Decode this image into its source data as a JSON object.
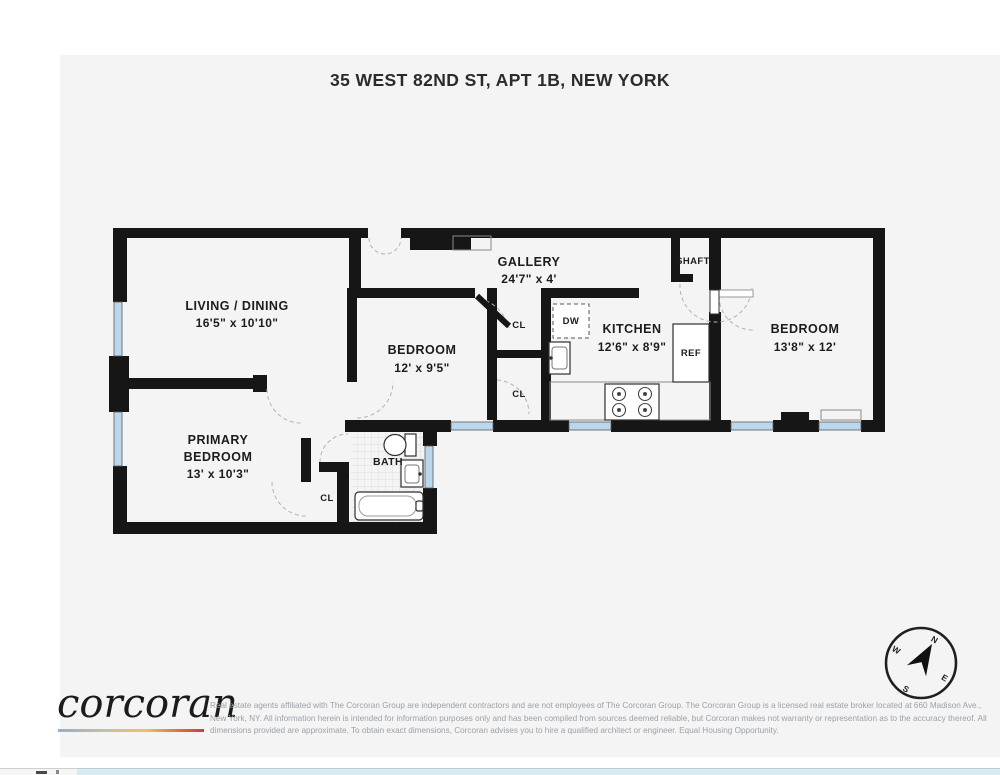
{
  "page": {
    "title": "35 WEST 82ND ST, APT 1B, NEW YORK"
  },
  "floorplan": {
    "rooms": {
      "living": {
        "name": "LIVING / DINING",
        "dims": "16'5\" x 10'10\""
      },
      "primary": {
        "name_line1": "PRIMARY",
        "name_line2": "BEDROOM",
        "dims": "13' x 10'3\""
      },
      "bedroom_mid": {
        "name": "BEDROOM",
        "dims": "12' x 9'5\""
      },
      "gallery": {
        "name": "GALLERY",
        "dims": "24'7\" x 4'"
      },
      "kitchen": {
        "name": "KITCHEN",
        "dims": "12'6\" x 8'9\""
      },
      "bedroom_right": {
        "name": "BEDROOM",
        "dims": "13'8\" x 12'"
      },
      "bath": {
        "name": "BATH"
      },
      "shaft": {
        "name": "SHAFT"
      }
    },
    "labels": {
      "closet": "CL",
      "dishwasher": "DW",
      "refrigerator": "REF"
    },
    "compass": {
      "n": "N",
      "e": "E",
      "s": "S",
      "w": "W"
    },
    "colors": {
      "wall": "#161616",
      "window": "#bcd7eb",
      "paper": "#f4f4f5"
    }
  },
  "footer": {
    "logo": "corcoran",
    "disclaimer": "Real estate agents affiliated with The Corcoran Group are independent contractors and are not employees of The Corcoran Group. The Corcoran Group is a licensed real estate broker located at 660 Madison Ave., New York, NY. All information herein is intended for information purposes only and has been compiled from sources deemed reliable, but Corcoran makes not warranty or representation as to the accuracy thereof. All dimensions provided are approximate. To obtain exact dimensions, Corcoran advises you to hire a qualified architect or engineer. Equal Housing Opportunity."
  }
}
